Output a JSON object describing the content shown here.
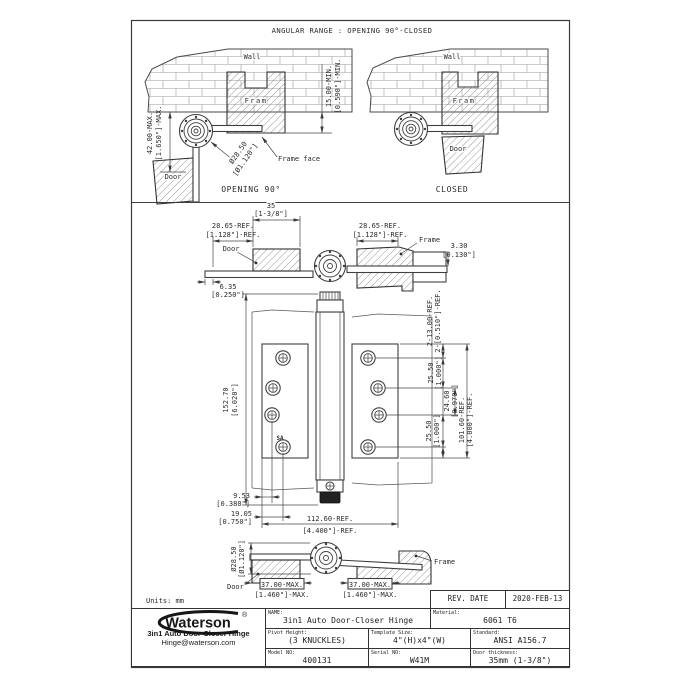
{
  "sheet": {
    "title": "ANGULAR RANGE : OPENING 90°-CLOSED",
    "units": "Units: mm"
  },
  "opening90": {
    "caption": "OPENING 90°",
    "wall": "Wall",
    "frame": "Fram",
    "door": "Door",
    "frame_face": "Frame face",
    "min_mm": "15.00-MIN.",
    "min_in": "[0.590\"]-MIN.",
    "max_mm": "42.00-MAX.",
    "max_in": "[1.650\"]-MAX.",
    "dia_mm": "Ø28.50",
    "dia_in": "[Ø1.120\"]"
  },
  "closed": {
    "caption": "CLOSED",
    "wall": "Wall",
    "frame": "Fram",
    "door": "Door"
  },
  "section_top": {
    "w35_mm": "35",
    "w35_in": "[1-3/8\"]",
    "left_ref_mm": "28.65-REF.",
    "left_ref_in": "[1.128\"]-REF.",
    "right_ref_mm": "28.65-REF.",
    "right_ref_in": "[1.128\"]-REF.",
    "door": "Door",
    "frame": "Frame",
    "t330_mm": "3.30",
    "t330_in": "[0.130\"]",
    "t635_mm": "6.35",
    "t635_in": "[0.250\"]"
  },
  "front": {
    "h_mm": "152.70",
    "h_in": "[6.020\"]",
    "holes_mm": "2-13.00-REF.",
    "holes_in": "2-[0.510\"]-REF.",
    "p1_mm": "25.50",
    "p1_in": "[1.000\"]",
    "p2_mm": "24.60",
    "p2_in": "[0.970\"]",
    "total_mm": "101.60-REF.",
    "total_in": "[4.000\"]-REF.",
    "p3_mm": "25.50",
    "p3_in": "[1.000\"]",
    "e1_mm": "9.53",
    "e1_in": "[0.380\"]",
    "e2_mm": "19.05",
    "e2_in": "[0.750\"]",
    "w_mm": "112.60-REF.",
    "w_in": "[4.400\"]-REF.",
    "sa": "SA"
  },
  "section_bottom": {
    "dia_mm": "Ø28.50",
    "dia_in": "[Ø1.120\"]",
    "door": "Door",
    "frame": "Frame",
    "left_max_mm": "37.00-MAX.",
    "left_max_in": "[1.460\"]-MAX.",
    "right_max_mm": "37.00-MAX.",
    "right_max_in": "[1.460\"]-MAX."
  },
  "title_block": {
    "rev_date_label": "REV. DATE",
    "rev_date_value": "2020-FEB-13",
    "name_label": "NAME:",
    "name_value": "3in1 Auto Door-Closer Hinge",
    "material_label": "Material:",
    "material_value": "6061 T6",
    "pivot_label": "Pivot Height:",
    "pivot_value": "(3 KNUCKLES)",
    "template_label": "Template Size:",
    "template_value": "4\"(H)x4\"(W)",
    "standard_label": "Standard:",
    "standard_value": "ANSI A156.7",
    "model_label": "Model NO:",
    "model_value": "400131",
    "serial_label": "Serial NO:",
    "serial_value": "W41M",
    "thickness_label": "Door thickness:",
    "thickness_value": "35mm (1-3/8\")"
  },
  "logo": {
    "brand": "Waterson",
    "reg": "®",
    "product": "3in1 Auto Door-Closer Hinge",
    "email": "Hinge@waterson.com"
  },
  "colors": {
    "line": "#3f3f3f",
    "text": "#2b2b2b",
    "insert": "#222222"
  }
}
